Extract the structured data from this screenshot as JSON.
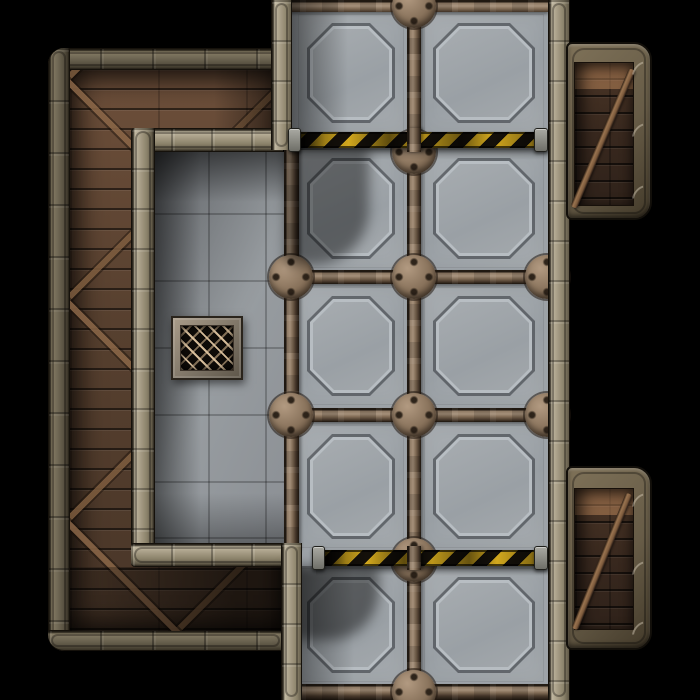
{
  "scene": {
    "title": "Sci-fi dungeon battle map tile",
    "description": "Top-down industrial map: west room ringed by a wooden walkway, gray tiled floor with a mesh floor grate, a north-south corridor of large riveted steel plates crossed by two yellow-black caution stripes, and two plank-floored alcoves on the east side over a black void.",
    "canvas": {
      "width_px": 700,
      "height_px": 700
    }
  },
  "theme": {
    "bg": "#000000",
    "panel": "#9aa0a5",
    "tile": "#8f9398",
    "seam_rust_light": "#a5907a",
    "seam_rust_dark": "#4a3a2c",
    "wall_frame_light": "#a99f88",
    "wall_frame_olive": "#6f6754",
    "plank_brown": "#57402f",
    "alcove_plank": "#38281e",
    "brace_rust": "#8a6647",
    "hazard-yellow": "#d2a81e",
    "hazard-black": "#14100a",
    "grate_frame": "#8e8373",
    "grate_mesh_line": "#dcc6a4"
  },
  "map": {
    "regions": [
      {
        "name": "west-room",
        "floor": "gray stone tiles",
        "walls": "outer olive frame + wooden walkway + inner light frame"
      },
      {
        "name": "central-corridor",
        "floor": "large riveted steel plates with octagonal insets",
        "open": "north and south map edges"
      },
      {
        "name": "alcove-northeast",
        "floor": "dark wood planks with rust brace"
      },
      {
        "name": "alcove-southeast",
        "floor": "dark wood planks with rust brace"
      }
    ],
    "floor_panels": {
      "cols": [
        {
          "x": 298,
          "w": 106
        },
        {
          "x": 424,
          "w": 120
        }
      ],
      "rows": [
        {
          "y": 14,
          "h": 118
        },
        {
          "y": 149,
          "h": 119
        },
        {
          "y": 287,
          "h": 118
        },
        {
          "y": 425,
          "h": 123
        },
        {
          "y": 568,
          "h": 114
        }
      ]
    },
    "seam_junctions": [
      {
        "x": 414,
        "y": 6
      },
      {
        "x": 414,
        "y": 152
      },
      {
        "x": 414,
        "y": 277
      },
      {
        "x": 414,
        "y": 415
      },
      {
        "x": 414,
        "y": 560
      },
      {
        "x": 414,
        "y": 692
      },
      {
        "x": 291,
        "y": 277
      },
      {
        "x": 291,
        "y": 415
      },
      {
        "x": 547,
        "y": 277
      },
      {
        "x": 547,
        "y": 415
      }
    ],
    "features": {
      "caution_stripe_north": {
        "x": 292,
        "y": 132,
        "w": 256,
        "h": 16
      },
      "caution_stripe_south": {
        "x": 316,
        "y": 550,
        "w": 232,
        "h": 16
      },
      "floor_grate": {
        "x": 171,
        "y": 316,
        "w": 72,
        "h": 64
      }
    }
  }
}
